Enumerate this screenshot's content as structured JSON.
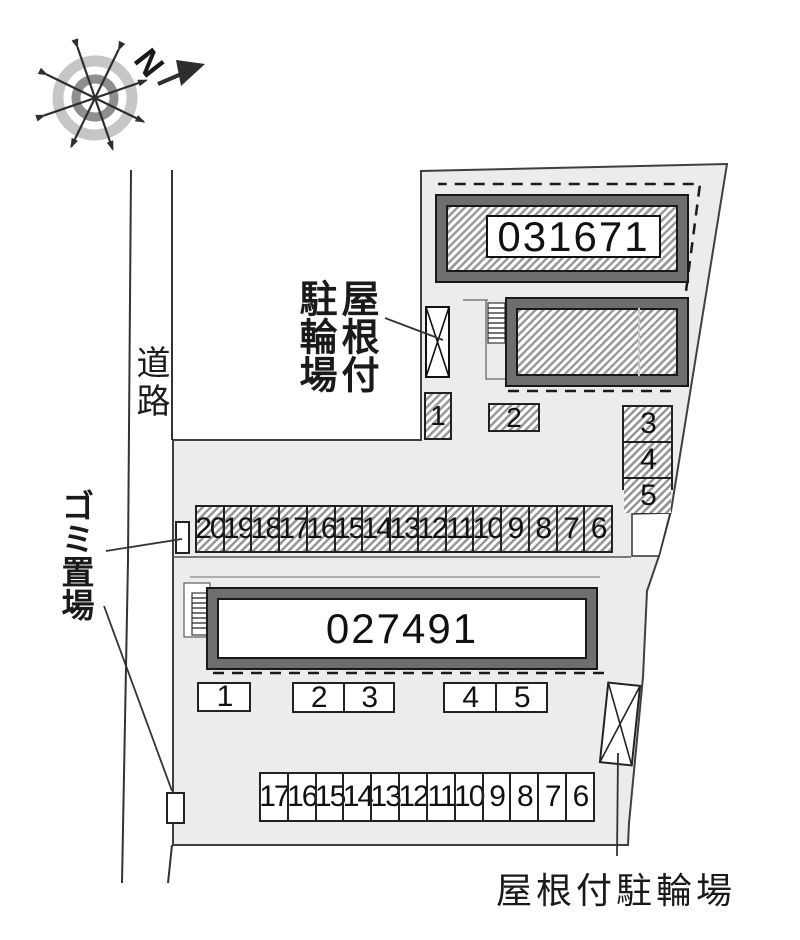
{
  "map": {
    "compass_n": "N",
    "road_label": "道路",
    "garbage_label": "ゴミ置場",
    "covered_bike_col_right": "屋根付",
    "covered_bike_col_left": "駐輪場",
    "covered_bike_bottom": "屋根付駐輪場"
  },
  "buildings": {
    "a": "031671",
    "b": "027491"
  },
  "parking": {
    "upper_space_1": "1",
    "upper_space_2": "2",
    "right_column": [
      "3",
      "4",
      "5"
    ],
    "hatched_row": [
      "20",
      "19",
      "18",
      "17",
      "16",
      "15",
      "14",
      "13",
      "12",
      "11",
      "10",
      "9",
      "8",
      "7",
      "6"
    ],
    "white_single": [
      "1"
    ],
    "white_pair_a": [
      "2",
      "3"
    ],
    "white_pair_b": [
      "4",
      "5"
    ],
    "bottom_row": [
      "17",
      "16",
      "15",
      "14",
      "13",
      "12",
      "11",
      "10",
      "9",
      "8",
      "7",
      "6"
    ]
  }
}
